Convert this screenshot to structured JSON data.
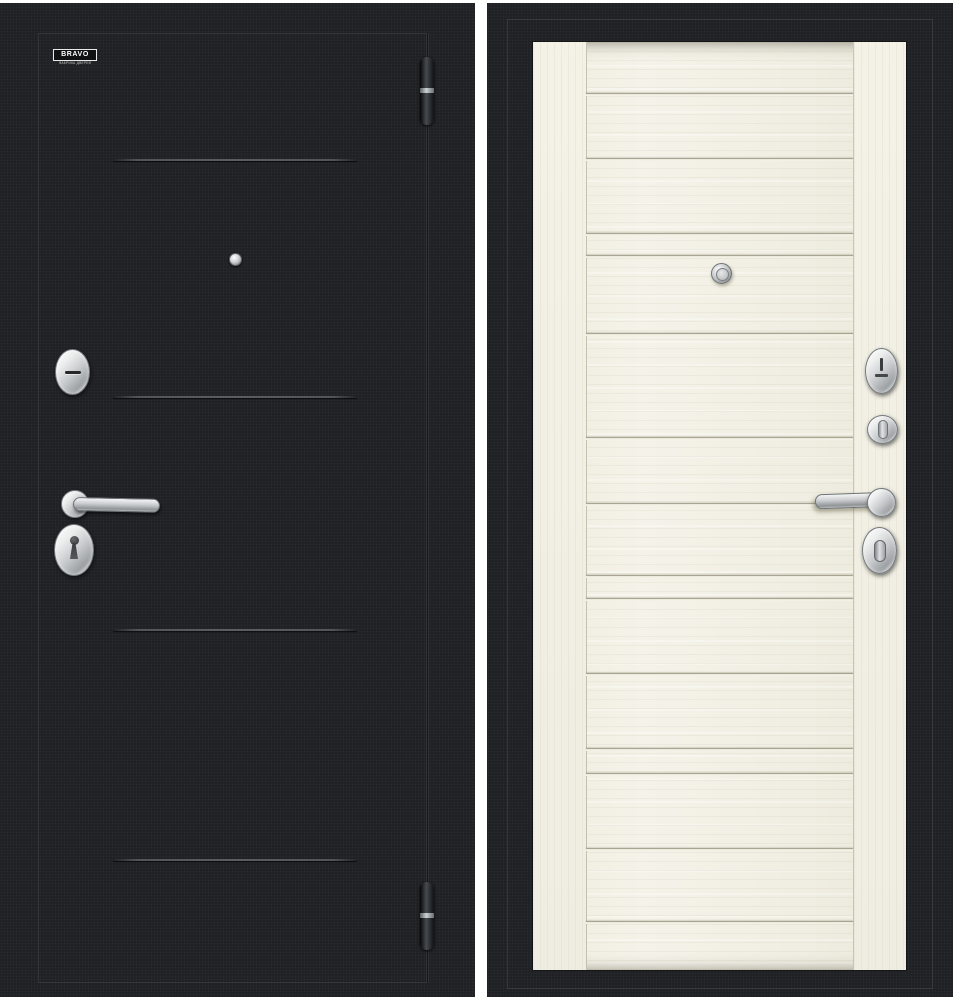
{
  "page": {
    "background_color": "#ffffff"
  },
  "brand_badge": {
    "title": "BRAVO",
    "subtitle": "ФАБРИКА ДВЕРЕЙ"
  },
  "left_door": {
    "label": "exterior-side-black",
    "base_color": "#1d1f22",
    "etched_line_color": "#5a5e63",
    "hardware_finish": "chrome",
    "etched_lines_y": [
      125,
      362,
      595,
      825
    ],
    "etched_line_left": 74,
    "etched_line_width": 244,
    "hardware": [
      "cylinder-cover",
      "lever-handle",
      "keyhole-escutcheon",
      "peephole",
      "top-hinge",
      "bottom-hinge"
    ]
  },
  "right_door": {
    "label": "interior-side-light-oak",
    "frame_color": "#1d1f22",
    "leaf_color": "#f1efe4",
    "groove_color": "#a8a593",
    "hardware_finish": "chrome",
    "grooves_y": [
      51,
      116,
      191,
      213,
      291,
      395,
      461,
      533,
      556,
      631,
      706,
      731,
      806,
      879
    ],
    "groove_left": 53,
    "groove_width": 267,
    "hardware": [
      "escutcheon",
      "night-latch-knob",
      "lever-handle",
      "thumbturn",
      "peephole"
    ]
  }
}
